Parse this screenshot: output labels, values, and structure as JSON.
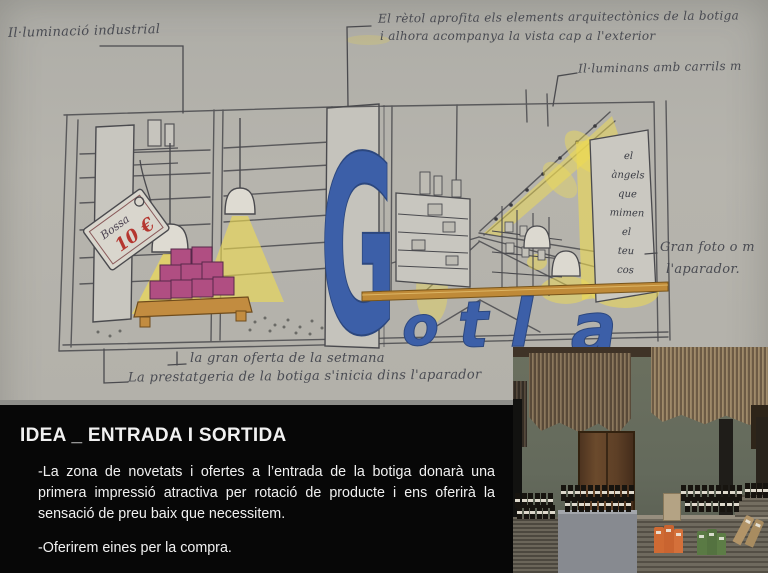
{
  "slide": {
    "paper_color": "#b3b1aa"
  },
  "sketch": {
    "sign": {
      "word": "Gotla",
      "letters": [
        "G",
        "o",
        "t",
        "l",
        "a"
      ],
      "color": "#3c5fa8"
    },
    "price_tag": {
      "label": "Bossa",
      "price": "10 €",
      "price_color": "#b5362f"
    },
    "panel_words": [
      "el",
      "àngels",
      "que",
      "mimen",
      "el",
      "teu",
      "cos"
    ],
    "annotations": {
      "top_left": "Il·luminació industrial",
      "top_right_1": "El rètol aprofita els elements arquitectònics de la botiga",
      "top_right_2": "i alhora acompanya la vista cap a l'exterior",
      "rail": "Il·luminans amb carrils m",
      "photo_ref_1": "Gran foto o m",
      "photo_ref_2": "l'aparador.",
      "bottom_1": "la gran oferta de la setmana",
      "bottom_2": "La prestatgeria de la botiga s'inicia dins l'aparador"
    },
    "colors": {
      "highlight_yellow": "#efdb52",
      "shelf_tan": "#bf8a38",
      "product_magenta": "#b04e82",
      "line": "#4a4a4e"
    }
  },
  "text_panel": {
    "title": "IDEA _ ENTRADA I SORTIDA",
    "paragraph_1": "-La zona de novetats i ofertes a l’entrada de la botiga donarà una primera impressió atractiva per rotació de producte i ens oferirà la sensació de preu baix que necessitem.",
    "paragraph_2": "-Oferirem eines per la compra.",
    "background": "#070707",
    "text_color": "#f1f1f1"
  },
  "photo": {
    "colors": {
      "wall": "#676d5f",
      "fringe": "#7b6951",
      "door": "#5d3f26",
      "plinth": "#878a90",
      "pack_orange": "#cf6a33",
      "pack_green": "#5a7a44",
      "pack_tan": "#b29468"
    },
    "bottle_rows": [
      {
        "x": 2,
        "y": 146,
        "count": 6,
        "gap": 6.5,
        "h": 15
      },
      {
        "x": 4,
        "y": 158,
        "count": 6,
        "gap": 6.5,
        "h": 14
      },
      {
        "x": 48,
        "y": 138,
        "count": 11,
        "gap": 6.8,
        "h": 16
      },
      {
        "x": 52,
        "y": 150,
        "count": 10,
        "gap": 6.8,
        "h": 15
      },
      {
        "x": 168,
        "y": 138,
        "count": 9,
        "gap": 7,
        "h": 16
      },
      {
        "x": 172,
        "y": 150,
        "count": 8,
        "gap": 7,
        "h": 15
      },
      {
        "x": 232,
        "y": 136,
        "count": 4,
        "gap": 6,
        "h": 15
      }
    ]
  }
}
